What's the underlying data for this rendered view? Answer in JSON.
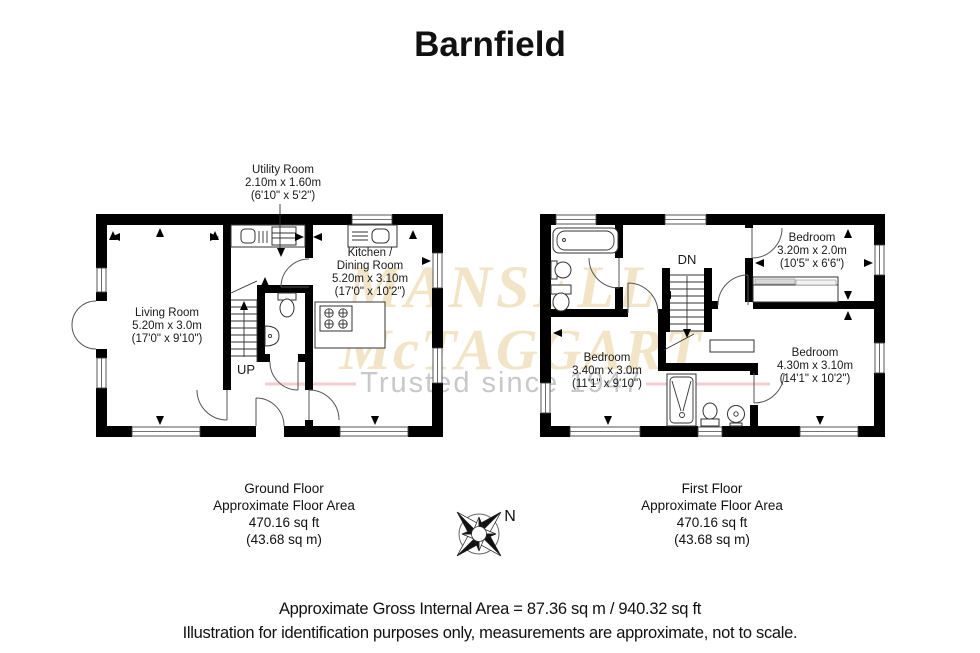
{
  "title": "Barnfield",
  "watermark": {
    "line1": "MANSELL",
    "line2": "McTAGGART",
    "tagline": "Trusted since 1947",
    "text_color": "#f2e4c6",
    "tagline_color": "#c8c8c8",
    "line_color": "#f3ccd1"
  },
  "ground_floor": {
    "stairs_label": "UP",
    "rooms": {
      "utility": {
        "lines": [
          "Utility Room",
          "2.10m x 1.60m",
          "(6'10\" x 5'2\")"
        ]
      },
      "living": {
        "lines": [
          "Living Room",
          "5.20m x 3.0m",
          "(17'0\" x 9'10\")"
        ]
      },
      "kitchen": {
        "lines": [
          "Kitchen /",
          "Dining Room",
          "5.20m x 3.10m",
          "(17'0\" x 10'2\")"
        ]
      }
    },
    "caption": {
      "lines": [
        "Ground Floor",
        "Approximate Floor Area",
        "470.16 sq ft",
        "(43.68 sq m)"
      ]
    }
  },
  "first_floor": {
    "stairs_label": "DN",
    "rooms": {
      "bedroom1": {
        "lines": [
          "Bedroom",
          "3.20m x 2.0m",
          "(10'5\" x 6'6\")"
        ]
      },
      "bedroom2": {
        "lines": [
          "Bedroom",
          "3.40m x 3.0m",
          "(11'1\" x 9'10\")"
        ]
      },
      "bedroom3": {
        "lines": [
          "Bedroom",
          "4.30m x 3.10m",
          "(14'1\" x 10'2\")"
        ]
      }
    },
    "caption": {
      "lines": [
        "First Floor",
        "Approximate Floor Area",
        "470.16 sq ft",
        "(43.68 sq m)"
      ]
    }
  },
  "compass": {
    "label": "N"
  },
  "footer": {
    "line1": "Approximate Gross Internal Area = 87.36 sq m / 940.32 sq ft",
    "line2": "Illustration for identification purposes only, measurements are approximate, not to scale."
  },
  "colors": {
    "walls": "#000000",
    "background": "#ffffff"
  }
}
